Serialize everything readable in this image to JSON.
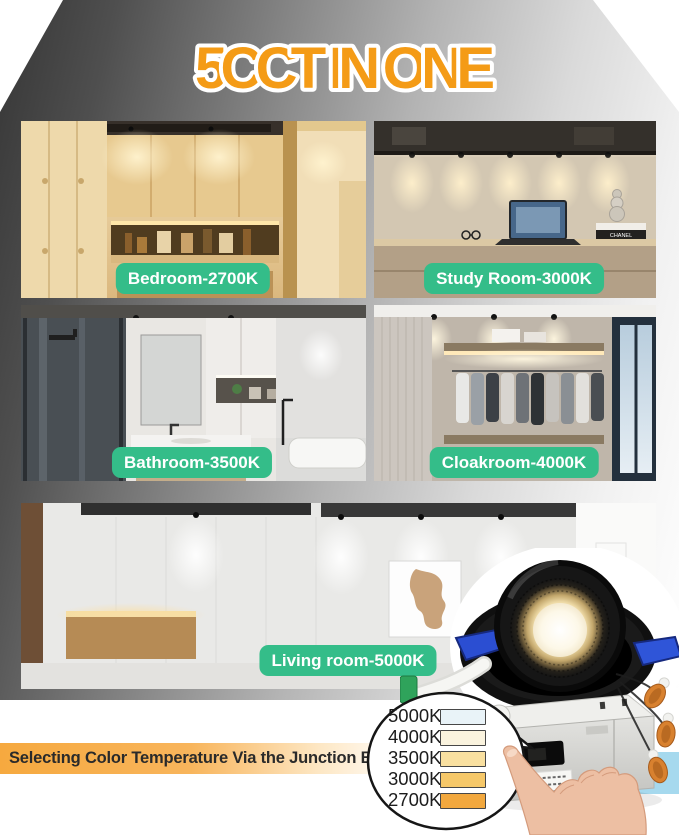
{
  "title": "5CCT IN ONE",
  "caption": "Selecting Color Temperature Via the Junction Box",
  "rooms": [
    {
      "id": "bedroom",
      "label": "Bedroom-2700K"
    },
    {
      "id": "study",
      "label": "Study Room-3000K"
    },
    {
      "id": "bathroom",
      "label": "Bathroom-3500K"
    },
    {
      "id": "cloakroom",
      "label": "Cloakroom-4000K"
    },
    {
      "id": "living",
      "label": "Living room-5000K"
    }
  ],
  "cct_chart": {
    "type": "table",
    "rows": [
      {
        "label": "5000K",
        "swatch": "#e9f3f8"
      },
      {
        "label": "4000K",
        "swatch": "#faf3de"
      },
      {
        "label": "3500K",
        "swatch": "#f9e0a0"
      },
      {
        "label": "3000K",
        "swatch": "#f6c869"
      },
      {
        "label": "2700K",
        "swatch": "#f2a83e"
      }
    ]
  },
  "photo_details": {
    "book_spine_text": "CHANEL"
  },
  "colors": {
    "badge_green": "#34bd89",
    "title_orange": "#f49b16",
    "caption_orange": "#f6a93f",
    "clip_blue": "#2b4ed2",
    "backdrop_blue": "#a6d9ee"
  }
}
